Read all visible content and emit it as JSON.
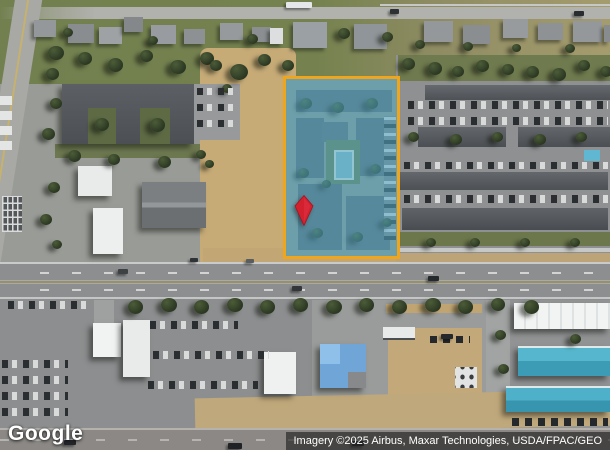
{
  "map": {
    "view_type": "satellite-imagery",
    "logo_text": "Google",
    "attribution_text": "Imagery ©2025 Airbus, Maxar Technologies, USDA/FPAC/GEO"
  },
  "parcel_overlay": {
    "marker_icon": "map-pin-icon",
    "boundary_icon": "parcel-boundary-rectangle"
  },
  "colors": {
    "parcel-border": "#F0A51B",
    "parcel-fill": "rgba(77,172,203,0.5)",
    "pin-red": "#D2202F",
    "pin-red-dark": "#A31420",
    "attribution-bg": "rgba(28,28,28,0.62)",
    "attribution-fg": "#FFFFFF",
    "logo-fg": "#FFFFFF"
  }
}
